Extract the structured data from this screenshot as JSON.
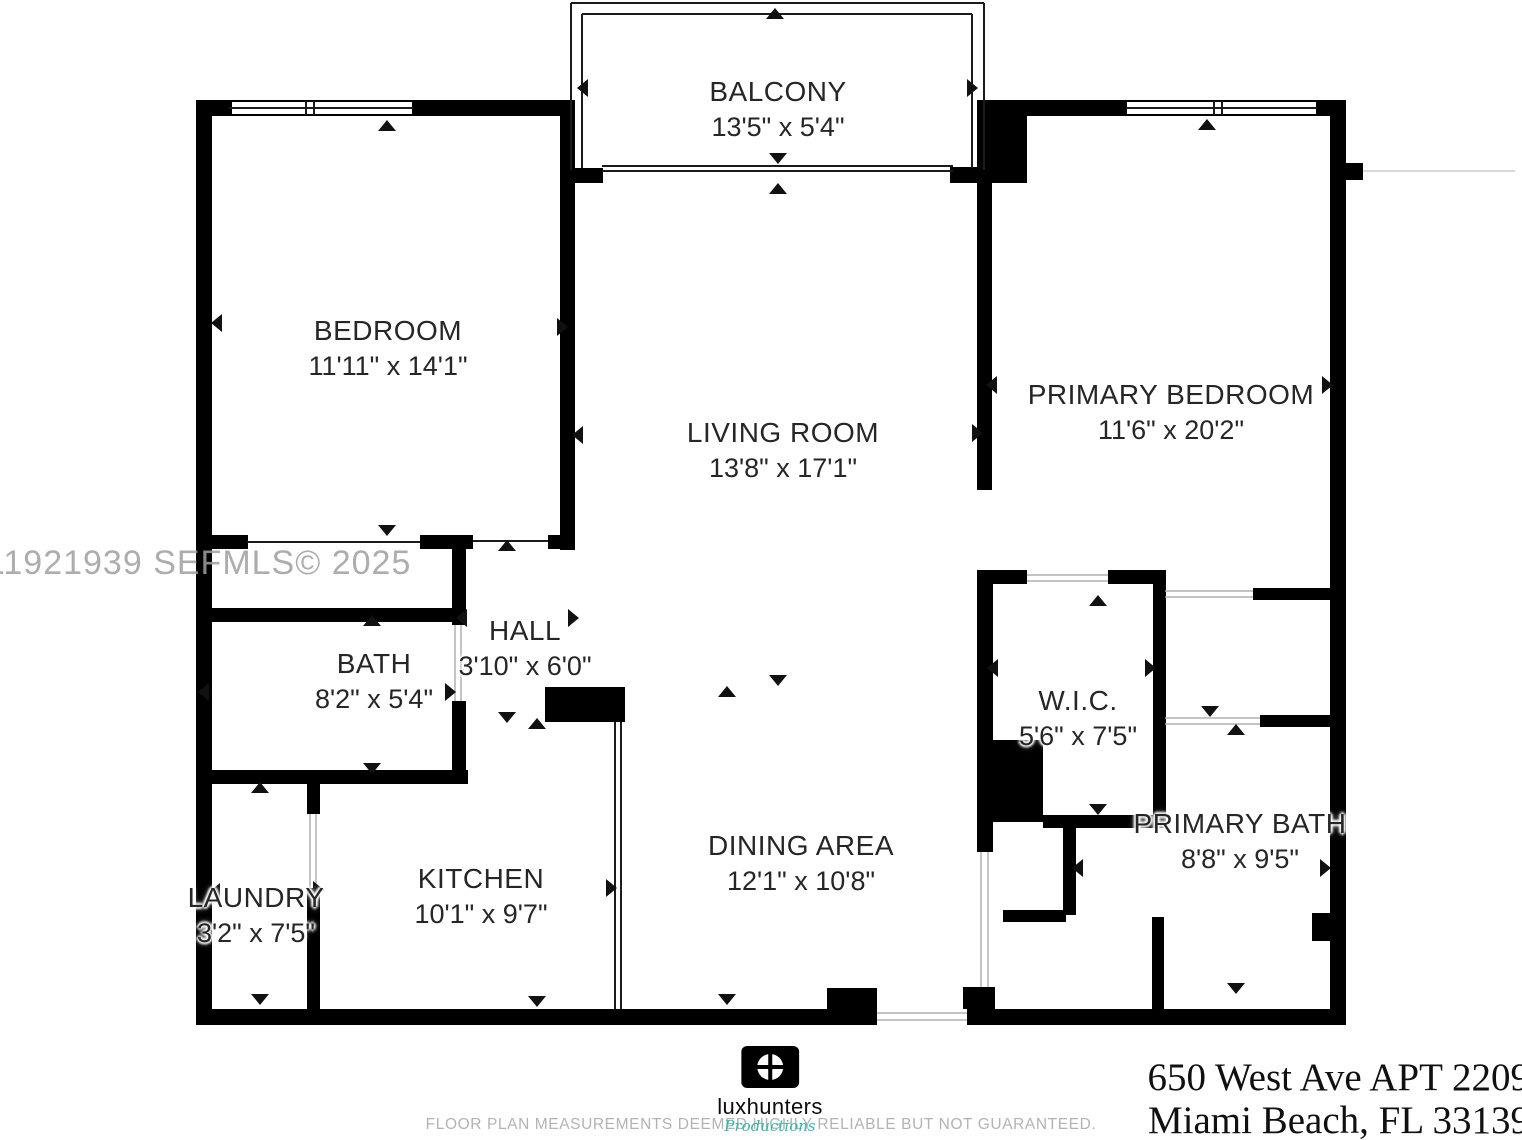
{
  "watermark": "11921939  SEFMLS© 2025",
  "rooms": [
    {
      "name": "BALCONY",
      "dims": "13'5\" x 5'4\""
    },
    {
      "name": "BEDROOM",
      "dims": "11'11\" x 14'1\""
    },
    {
      "name": "LIVING ROOM",
      "dims": "13'8\" x 17'1\""
    },
    {
      "name": "PRIMARY BEDROOM",
      "dims": "11'6\" x 20'2\""
    },
    {
      "name": "HALL",
      "dims": "3'10\" x 6'0\""
    },
    {
      "name": "BATH",
      "dims": "8'2\" x 5'4\""
    },
    {
      "name": "W.I.C.",
      "dims": "5'6\" x 7'5\""
    },
    {
      "name": "PRIMARY BATH",
      "dims": "8'8\" x 9'5\""
    },
    {
      "name": "KITCHEN",
      "dims": "10'1\" x 9'7\""
    },
    {
      "name": "DINING AREA",
      "dims": "12'1\" x 10'8\""
    },
    {
      "name": "LAUNDRY",
      "dims": "3'2\" x 7'5\""
    }
  ],
  "footer": {
    "logo_name": "luxhunters",
    "logo_tagline": "Productions",
    "disclaimer": "FLOOR PLAN MEASUREMENTS DEEMED HIGHLY RELIABLE BUT NOT GUARANTEED.",
    "address_line1": "650 West Ave APT 2209",
    "address_line2": "Miami Beach, FL 33139"
  },
  "colors": {
    "wall": "#000000",
    "watermark_gray": "#9f9f9f",
    "tagline_teal": "#35b8ac",
    "disclaimer_gray": "#b3b3b3"
  }
}
